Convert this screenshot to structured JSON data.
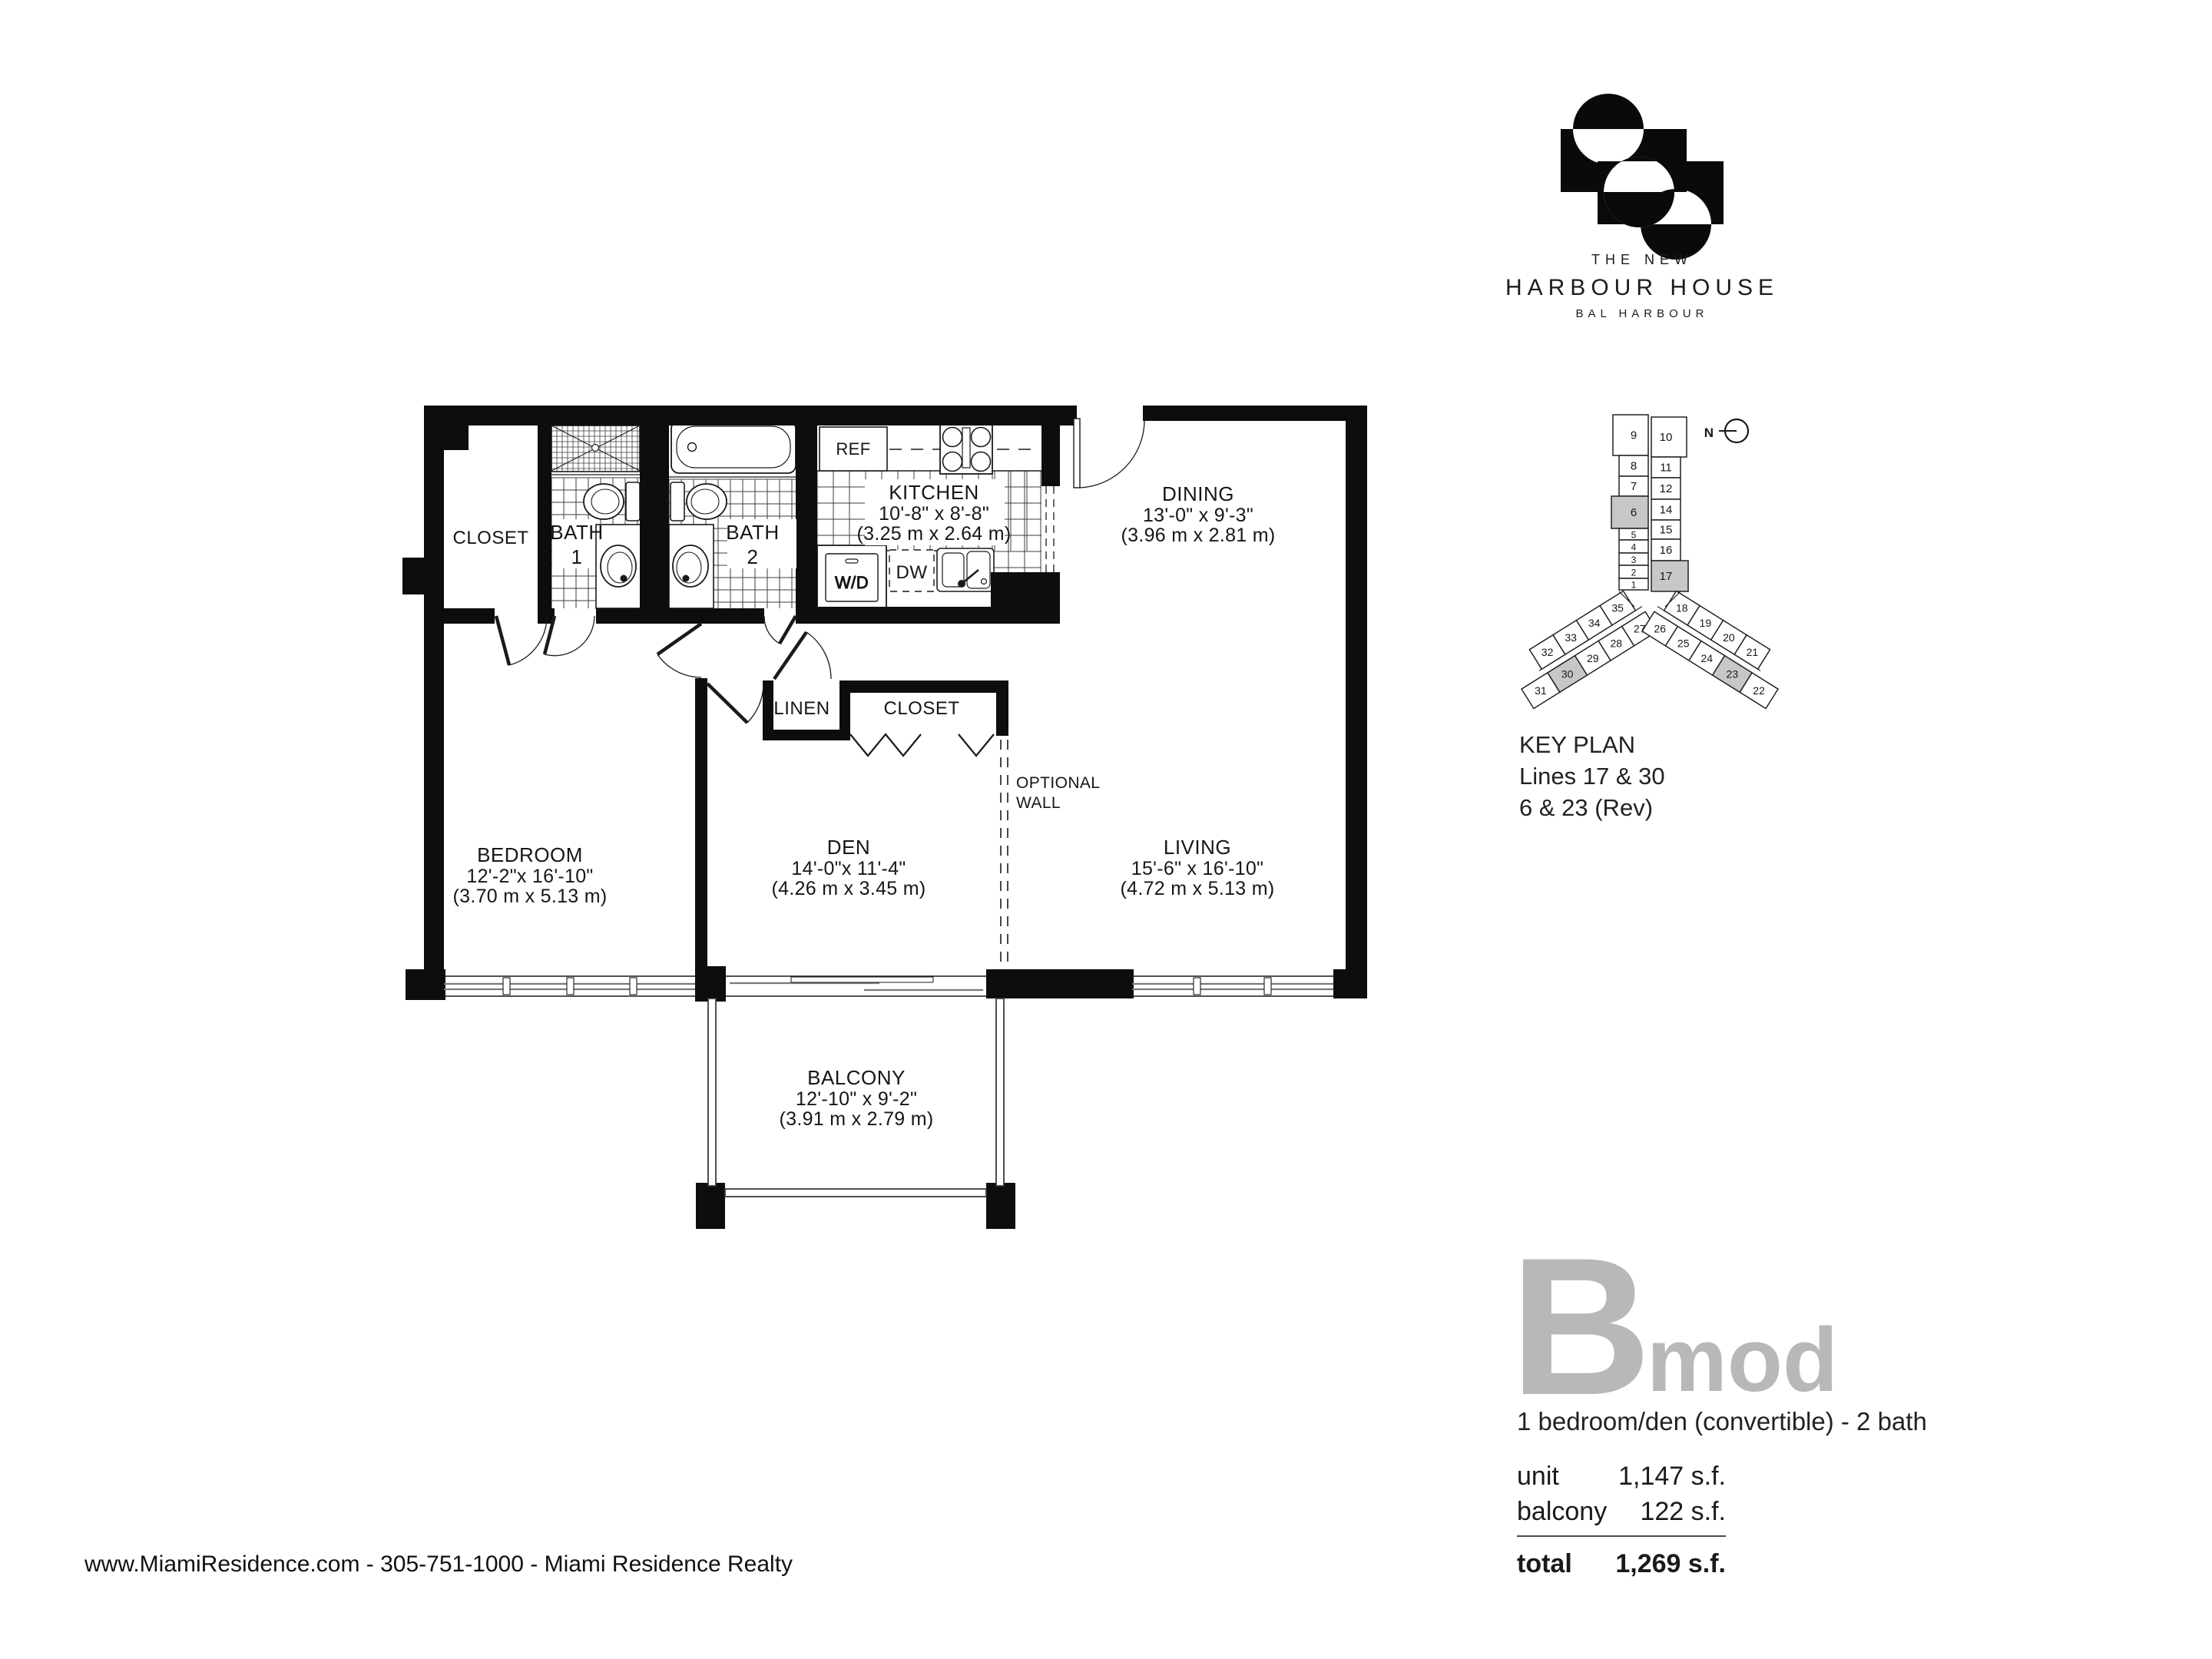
{
  "brand": {
    "the_new": "THE NEW",
    "name": "HARBOUR HOUSE",
    "location": "BAL HARBOUR"
  },
  "key_plan": {
    "title": "KEY PLAN",
    "line1": "Lines 17 & 30",
    "line2": "6 & 23 (Rev)",
    "north_label": "N",
    "tower_left": [
      "9",
      "8",
      "7",
      "6",
      "5",
      "4",
      "3",
      "2",
      "1"
    ],
    "tower_right": [
      "10",
      "11",
      "12",
      "14",
      "15",
      "16",
      "17"
    ],
    "wing_left_outer": [
      "35",
      "34",
      "33",
      "32"
    ],
    "wing_left_inner": [
      "27",
      "28",
      "29",
      "30",
      "31"
    ],
    "wing_right_outer": [
      "18",
      "19",
      "20",
      "21"
    ],
    "wing_right_inner": [
      "26",
      "25",
      "24",
      "23",
      "22"
    ],
    "highlighted": [
      "6",
      "17",
      "30",
      "23"
    ]
  },
  "unit": {
    "plan_letter": "B",
    "plan_suffix": "mod",
    "description": "1 bedroom/den (convertible) - 2 bath",
    "stats": [
      {
        "label": "unit",
        "value": "1,147 s.f."
      },
      {
        "label": "balcony",
        "value": "122 s.f."
      }
    ],
    "total_label": "total",
    "total_value": "1,269 s.f."
  },
  "rooms": {
    "closet": {
      "name": "CLOSET"
    },
    "bath1": {
      "name": "BATH",
      "number": "1"
    },
    "bath2": {
      "name": "BATH",
      "number": "2"
    },
    "kitchen": {
      "name": "KITCHEN",
      "imperial": "10'-8\" x 8'-8\"",
      "metric": "(3.25 m x 2.64 m)"
    },
    "dining": {
      "name": "DINING",
      "imperial": "13'-0\" x 9'-3\"",
      "metric": "(3.96 m x 2.81 m)"
    },
    "linen": {
      "name": "LINEN"
    },
    "closet2": {
      "name": "CLOSET"
    },
    "optional_wall_1": "OPTIONAL",
    "optional_wall_2": "WALL",
    "bedroom": {
      "name": "BEDROOM",
      "imperial": "12'-2\"x 16'-10\"",
      "metric": "(3.70 m x 5.13 m)"
    },
    "den": {
      "name": "DEN",
      "imperial": "14'-0\"x 11'-4\"",
      "metric": "(4.26 m x 3.45 m)"
    },
    "living": {
      "name": "LIVING",
      "imperial": "15'-6\" x 16'-10\"",
      "metric": "(4.72 m x 5.13 m)"
    },
    "balcony": {
      "name": "BALCONY",
      "imperial": "12'-10\" x 9'-2\"",
      "metric": "(3.91 m x 2.79 m)"
    }
  },
  "appliances": {
    "ref": "REF",
    "dw": "DW",
    "wd": "W/D"
  },
  "footer": {
    "text": "www.MiamiResidence.com  -  305-751-1000  -  Miami Residence Realty"
  },
  "colors": {
    "accent_gray": "#b6b8ba",
    "highlight": "#c7c7c7",
    "ink": "#161616"
  }
}
